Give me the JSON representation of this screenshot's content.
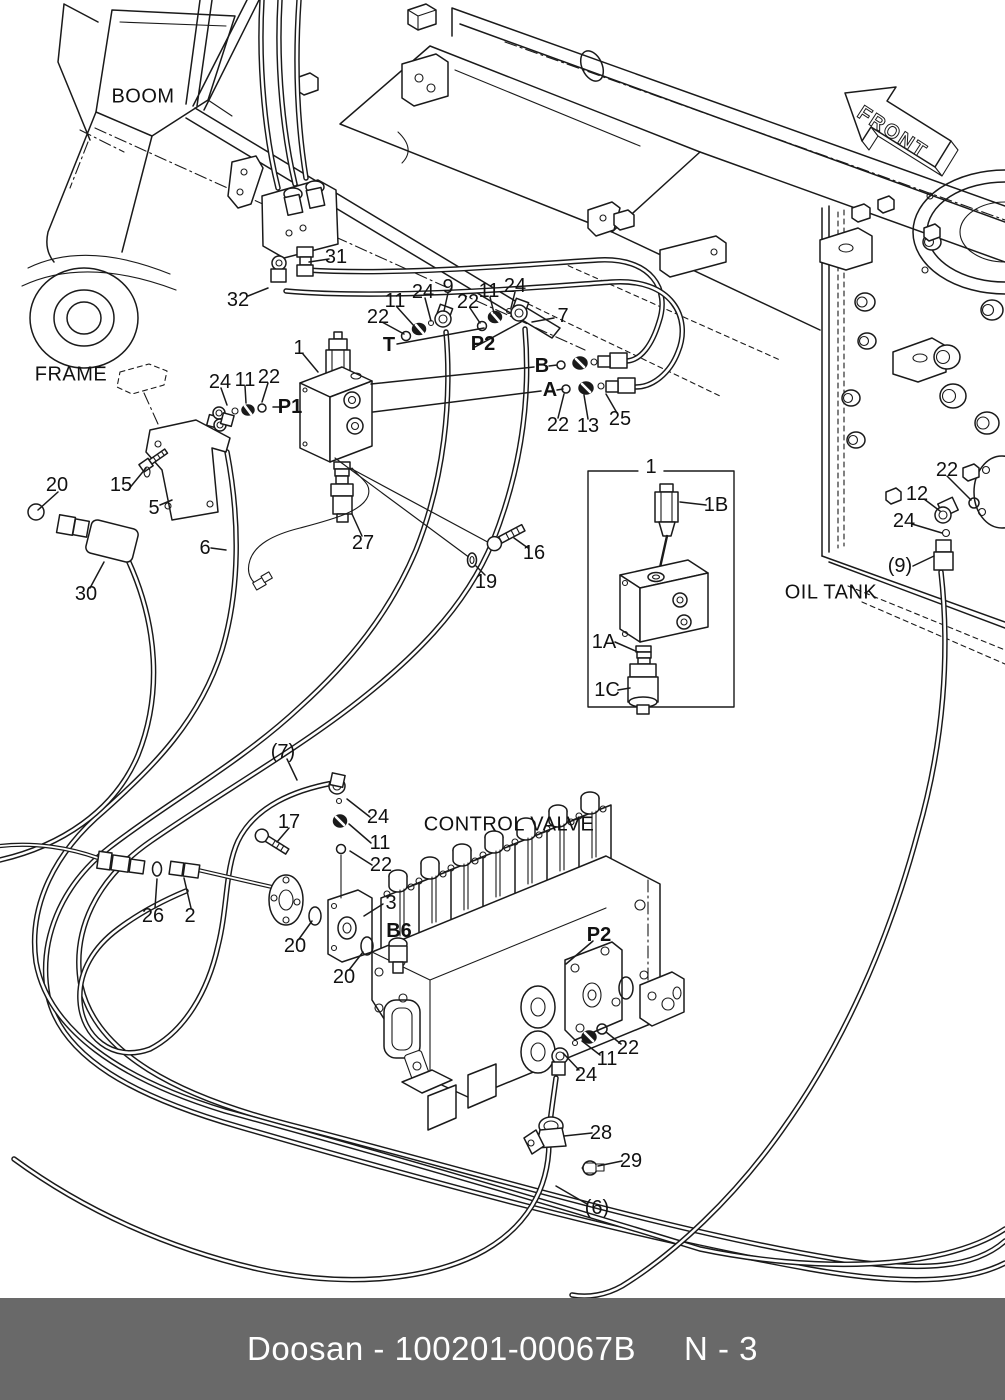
{
  "diagram": {
    "area_labels": {
      "boom": "BOOM",
      "frame": "FRAME",
      "front": "FRONT",
      "oil_tank": "OIL TANK",
      "control_valve": "CONTROL VALVE"
    },
    "callouts": [
      {
        "text": "31"
      },
      {
        "text": "32"
      },
      {
        "text": "22"
      },
      {
        "text": "11"
      },
      {
        "text": "24"
      },
      {
        "text": "9"
      },
      {
        "text": "22"
      },
      {
        "text": "11"
      },
      {
        "text": "24"
      },
      {
        "text": "7"
      },
      {
        "text": "1"
      },
      {
        "text": "T"
      },
      {
        "text": "P2"
      },
      {
        "text": "B"
      },
      {
        "text": "A"
      },
      {
        "text": "24"
      },
      {
        "text": "11"
      },
      {
        "text": "22"
      },
      {
        "text": "P1"
      },
      {
        "text": "22"
      },
      {
        "text": "13"
      },
      {
        "text": "25"
      },
      {
        "text": "20"
      },
      {
        "text": "15"
      },
      {
        "text": "5"
      },
      {
        "text": "6"
      },
      {
        "text": "30"
      },
      {
        "text": "27"
      },
      {
        "text": "16"
      },
      {
        "text": "19"
      },
      {
        "text": "1"
      },
      {
        "text": "1B"
      },
      {
        "text": "1A"
      },
      {
        "text": "1C"
      },
      {
        "text": "22"
      },
      {
        "text": "12"
      },
      {
        "text": "24"
      },
      {
        "text": "(9)"
      },
      {
        "text": "(7)"
      },
      {
        "text": "17"
      },
      {
        "text": "24"
      },
      {
        "text": "11"
      },
      {
        "text": "22"
      },
      {
        "text": "26"
      },
      {
        "text": "2"
      },
      {
        "text": "20"
      },
      {
        "text": "3"
      },
      {
        "text": "B6"
      },
      {
        "text": "20"
      },
      {
        "text": "P2"
      },
      {
        "text": "22"
      },
      {
        "text": "11"
      },
      {
        "text": "24"
      },
      {
        "text": "28"
      },
      {
        "text": "29"
      },
      {
        "text": "(6)"
      }
    ]
  },
  "footer": {
    "brand": "Doosan",
    "separator": " - ",
    "part_number": "100201-00067B",
    "page": "N - 3"
  }
}
